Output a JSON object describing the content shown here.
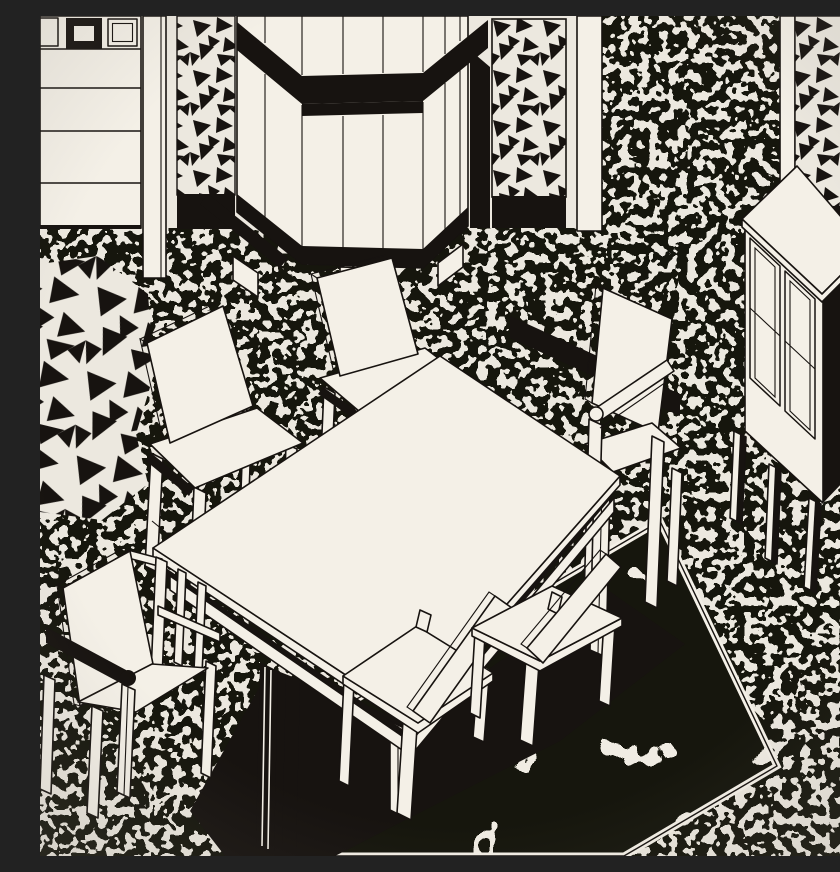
{
  "artwork": {
    "title": "Black-and-white postmodern dining-room interior",
    "style": "1980s Memphis-style pen-and-ink illustration, isometric view",
    "description": "Monochrome drawing of a dining room: a long white table with six slab-back chairs stands on a black rug with white crack veins; behind are a paneled wall with a square frieze, a tall folding screen with a black chevron top, pilasters, triangle-confetti panels and a tall-legged cabinet, all set against dense black speckle walls and floor.",
    "palette": {
      "paper": "#ece8df",
      "ink": "#171310",
      "furniture": "#f4f0e7"
    },
    "scene": {
      "background_elements": [
        {
          "name": "paneled-wall",
          "detail": "horizontal boards, square frieze on top"
        },
        {
          "name": "frieze-squares",
          "detail": "three outlined squares, middle one thick black"
        },
        {
          "name": "left-pilaster",
          "detail": "white post reaching the floor"
        },
        {
          "name": "triangle-column",
          "detail": "triangle confetti with black base block"
        },
        {
          "name": "folding-screen",
          "detail": "vertical panels, black chevron band, black plinth"
        },
        {
          "name": "triangle-panel-center",
          "detail": "confetti panel right of screen"
        },
        {
          "name": "speckle-wall-panel",
          "detail": "dense black speckle between pilasters"
        },
        {
          "name": "triangle-panel-right",
          "detail": "confetti panel with black band behind cabinet"
        },
        {
          "name": "highboy-cabinet",
          "detail": "two framed doors, black side, four tall thin legs"
        }
      ],
      "floor_elements": [
        {
          "name": "speckle-floor",
          "detail": "organic black speckle"
        },
        {
          "name": "triangle-floor-patch",
          "detail": "large loose black triangles, left edge"
        },
        {
          "name": "area-rug",
          "detail": "black diamond rug with white crack veins and white border"
        }
      ],
      "furniture": [
        {
          "name": "dining-table",
          "detail": "long white top, apron rails, one leg in black shadow"
        },
        {
          "name": "chair-rear-left",
          "detail": "tall slab back"
        },
        {
          "name": "chair-rear-middle",
          "detail": "tall slab back"
        },
        {
          "name": "armchair-right",
          "detail": "slab back with arm rail, black shadow band behind"
        },
        {
          "name": "chair-front-left",
          "detail": "seen from behind, tilted slab back"
        },
        {
          "name": "chair-front-right",
          "detail": "seen from behind, tilted slab back"
        },
        {
          "name": "armchair-front-left",
          "detail": "seen from behind, solid black armrest"
        }
      ],
      "patterns": {
        "speckle": "dense random black blobs on cream",
        "triangle-confetti": "scattered rotated black triangles on cream",
        "rug-cracks": "white crack veins on black field"
      }
    }
  }
}
